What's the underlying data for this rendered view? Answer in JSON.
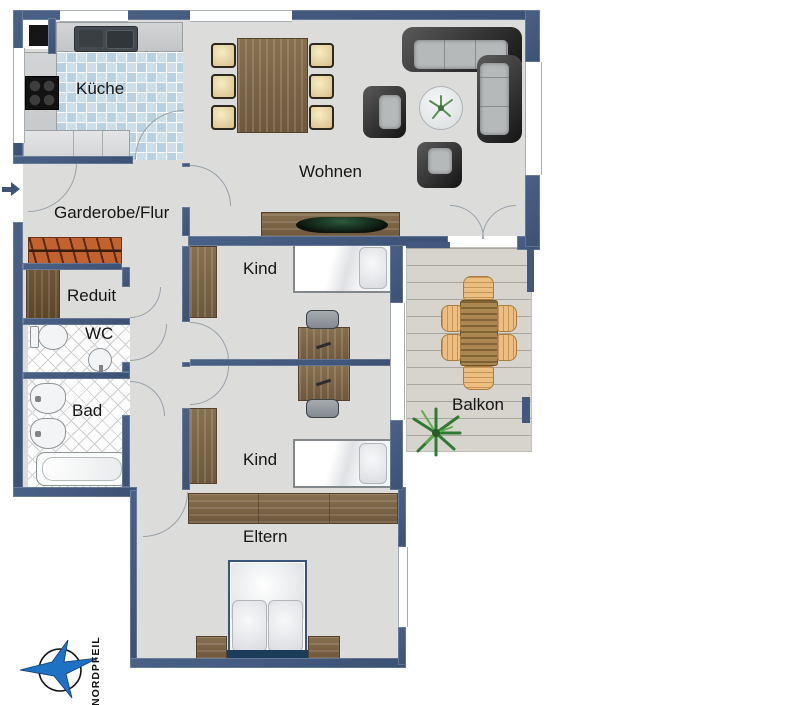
{
  "rooms": {
    "kueche": {
      "label": "Küche"
    },
    "wohnen": {
      "label": "Wohnen"
    },
    "garderobe": {
      "label": "Garderobe/Flur"
    },
    "reduit": {
      "label": "Reduit"
    },
    "wc": {
      "label": "WC"
    },
    "bad": {
      "label": "Bad"
    },
    "kind_oben": {
      "label": "Kind"
    },
    "kind_unten": {
      "label": "Kind"
    },
    "eltern": {
      "label": "Eltern"
    },
    "balkon": {
      "label": "Balkon"
    }
  },
  "compass": {
    "label": "NORDPFEIL"
  },
  "colors": {
    "wall": "#42597d",
    "floor": "#dcdddb",
    "kitchen_tile": "#bdd5e4",
    "balcony_deck": "#d7d4ce",
    "furniture_wood": "#7b6448",
    "wardrobe_rail": "#c2622e",
    "sofa_dark": "#2a2a2a",
    "chair_cream": "#ead9a9",
    "bed_frame_navy": "#1d3b5a",
    "compass_blue": "#1e72c4"
  }
}
